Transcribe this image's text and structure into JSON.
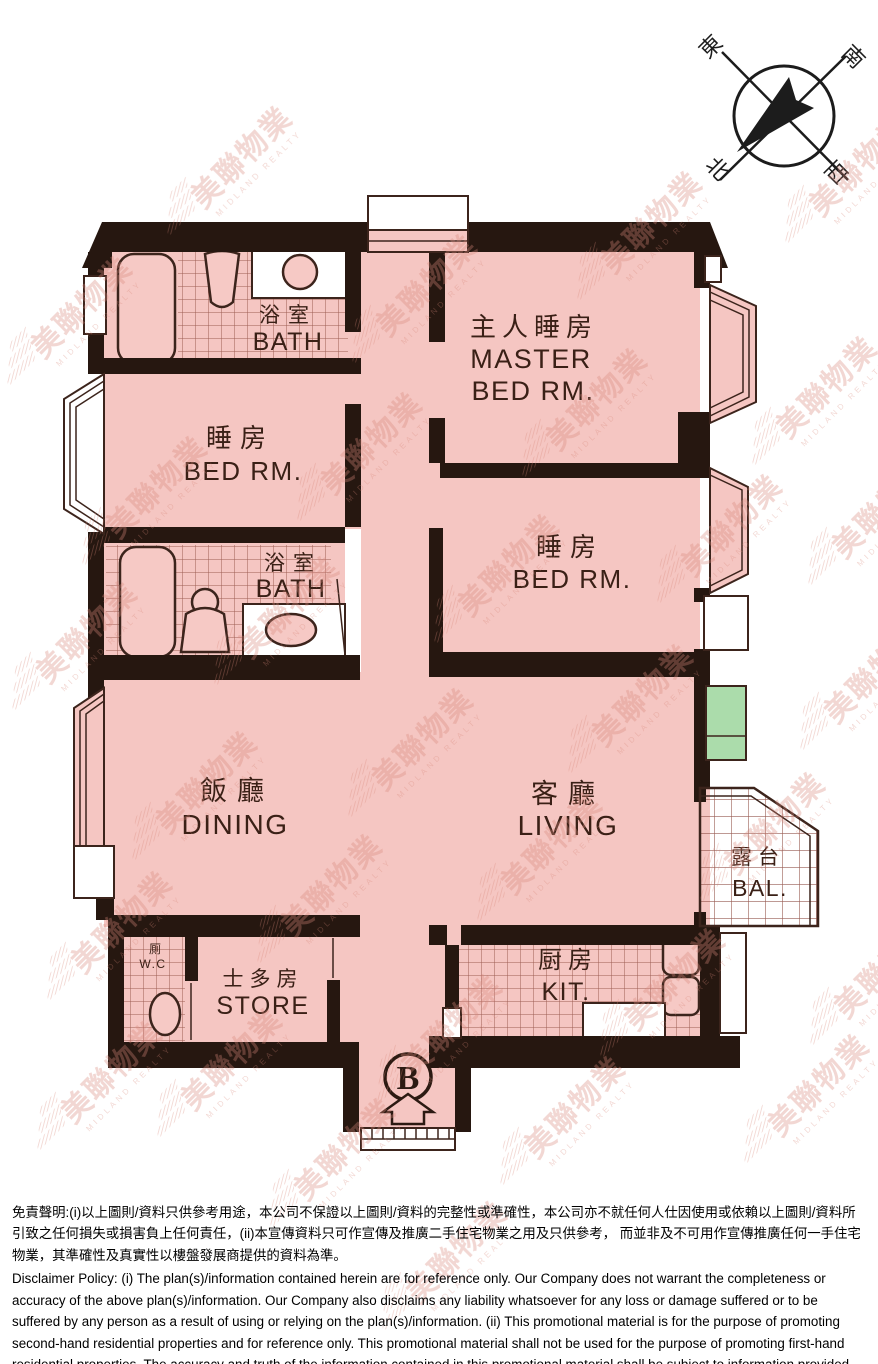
{
  "compass": {
    "east": "東",
    "south": "南",
    "north": "北",
    "west": "西"
  },
  "rooms": {
    "bath_top": {
      "zh": "浴室",
      "en": "BATH"
    },
    "master_bedroom": {
      "zh": "主人睡房",
      "en_line1": "MASTER",
      "en_line2": "BED RM."
    },
    "bedroom_left": {
      "zh": "睡房",
      "en": "BED RM."
    },
    "bath_middle": {
      "zh": "浴室",
      "en": "BATH"
    },
    "bedroom_right": {
      "zh": "睡房",
      "en": "BED RM."
    },
    "dining": {
      "zh": "飯廳",
      "en": "DINING"
    },
    "living": {
      "zh": "客廳",
      "en": "LIVING"
    },
    "balcony": {
      "zh": "露台",
      "en": "BAL."
    },
    "wc": {
      "zh": "厠",
      "en": "W.C"
    },
    "store": {
      "zh": "士多房",
      "en": "STORE"
    },
    "kitchen": {
      "zh": "厨房",
      "en": "KIT."
    }
  },
  "entrance": {
    "block_label": "B"
  },
  "watermark": {
    "zh": "美聯物業",
    "en": "MIDLAND REALTY"
  },
  "disclaimer": {
    "zh": "免責聲明:(i)以上圖則/資料只供參考用途，本公司不保證以上圖則/資料的完整性或準確性，本公司亦不就任何人仕因使用或依賴以上圖則/資料所引致之任何損失或損害負上任何責任，(ii)本宣傳資料只可作宣傳及推廣二手住宅物業之用及只供參考， 而並非及不可用作宣傳推廣任何一手住宅物業，其準確性及真實性以樓盤發展商提供的資料為準。",
    "en": "Disclaimer Policy: (i) The plan(s)/information contained herein are for reference only. Our Company does not warrant the completeness or accuracy of the above plan(s)/information. Our Company also disclaims any liability whatsoever for any loss or damage suffered or to be suffered by any person as a result of using or relying on the plan(s)/information. (ii) This promotional material is for the purpose of promoting second-hand residential properties and for reference only. This promotional material shall not be used for the purpose of promoting first-hand residential properties. The accuracy and truth of the information contained in this promotional material shall be subject to information provided by the developers."
  },
  "colors": {
    "floor_pink": "#f5c6c2",
    "wall_dark": "#261710",
    "tile_line": "#8d4a40",
    "green_panel": "#abdcab",
    "watermark": "#d98a7c",
    "label_text": "#3a2016"
  }
}
